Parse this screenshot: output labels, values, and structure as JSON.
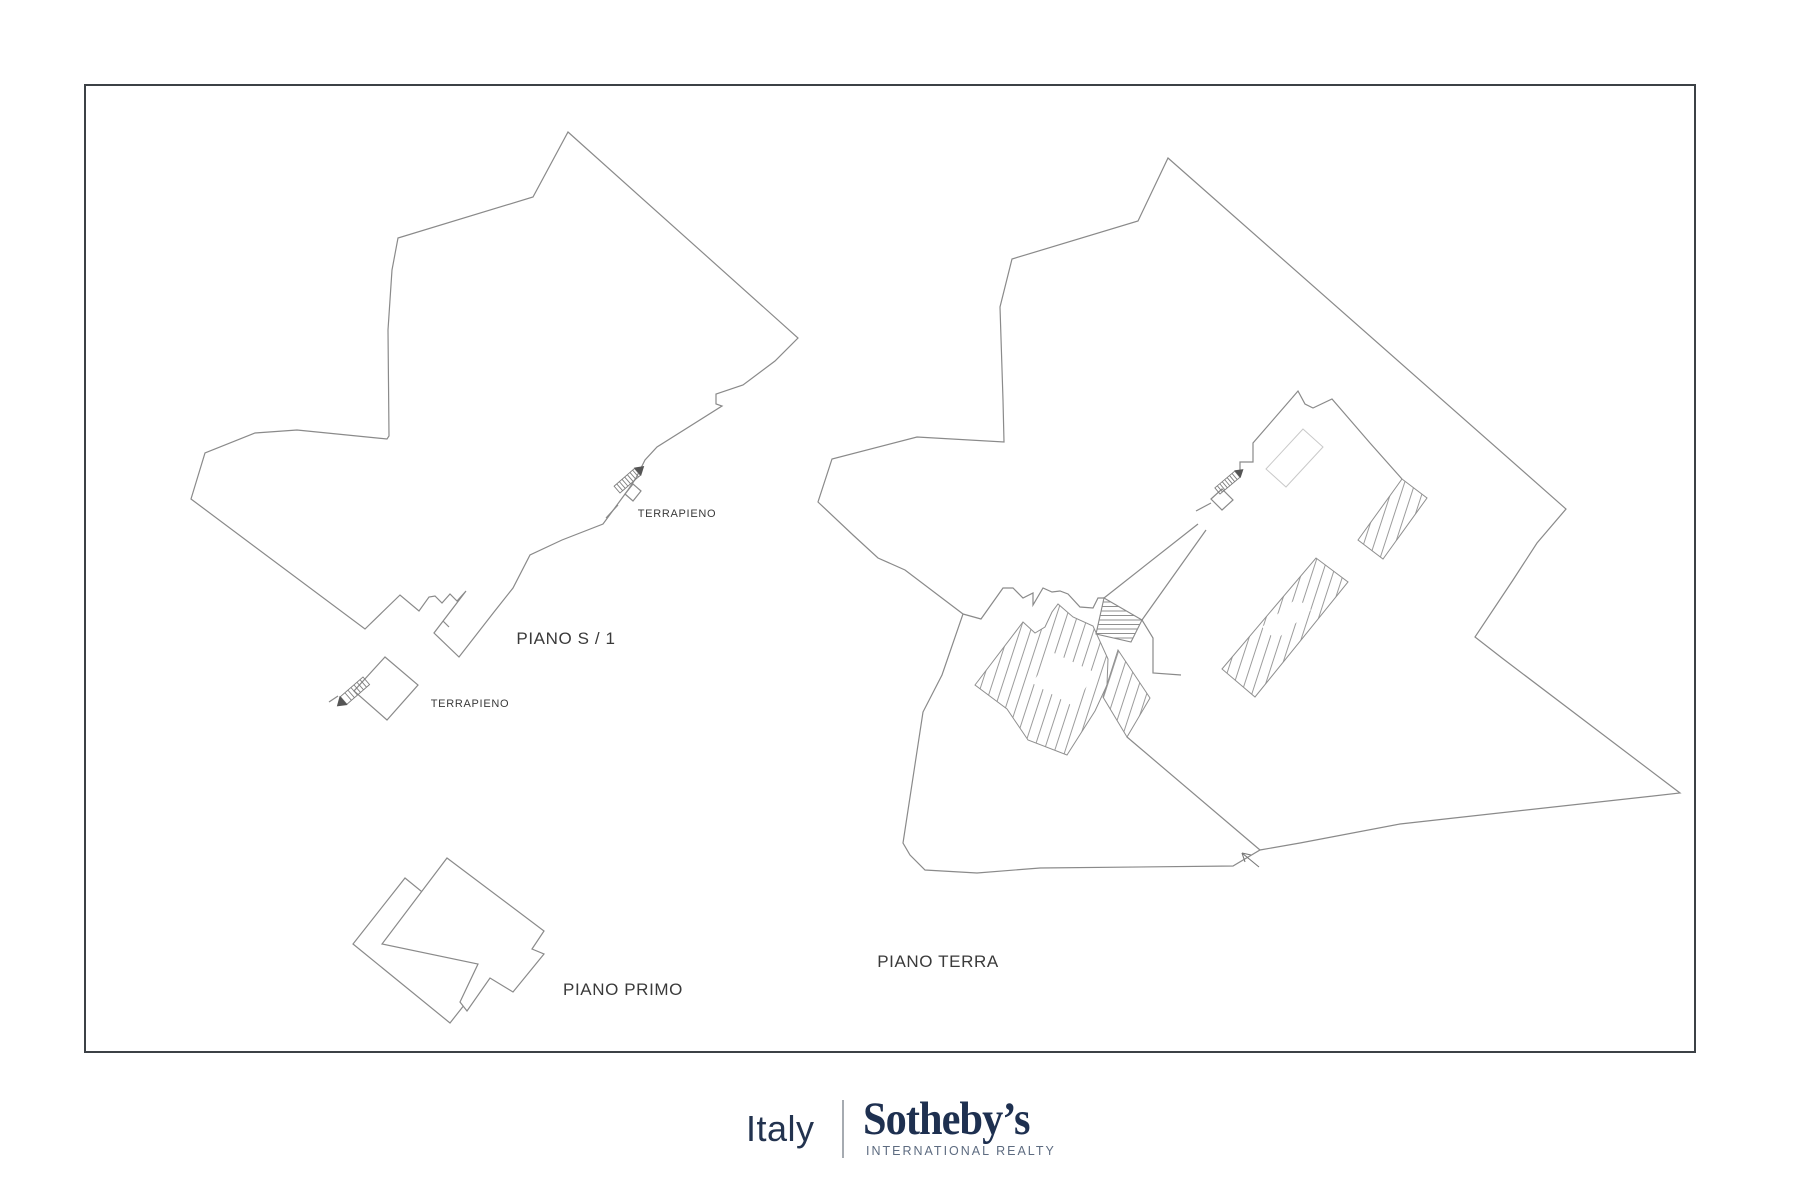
{
  "sheet": {
    "background": "#ffffff",
    "border_color": "#3c4146"
  },
  "drawing": {
    "line_color": "#8a8a8a",
    "hatch_color": "#9c9c9c",
    "light_outline_color": "#c9c9c9",
    "label_color": "#3a3a3a"
  },
  "labels": {
    "piano_s1": "PIANO S / 1",
    "piano_primo": "PIANO PRIMO",
    "piano_terra": "PIANO TERRA",
    "terrapieno_upper": "TERRAPIENO",
    "terrapieno_lower": "TERRAPIENO"
  },
  "logo": {
    "region": "Italy",
    "brand": "Sotheby’s",
    "tagline": "INTERNATIONAL REALTY",
    "navy": "#1e3050",
    "tagline_color": "#5d6b80",
    "divider_color": "#a6abb1"
  }
}
